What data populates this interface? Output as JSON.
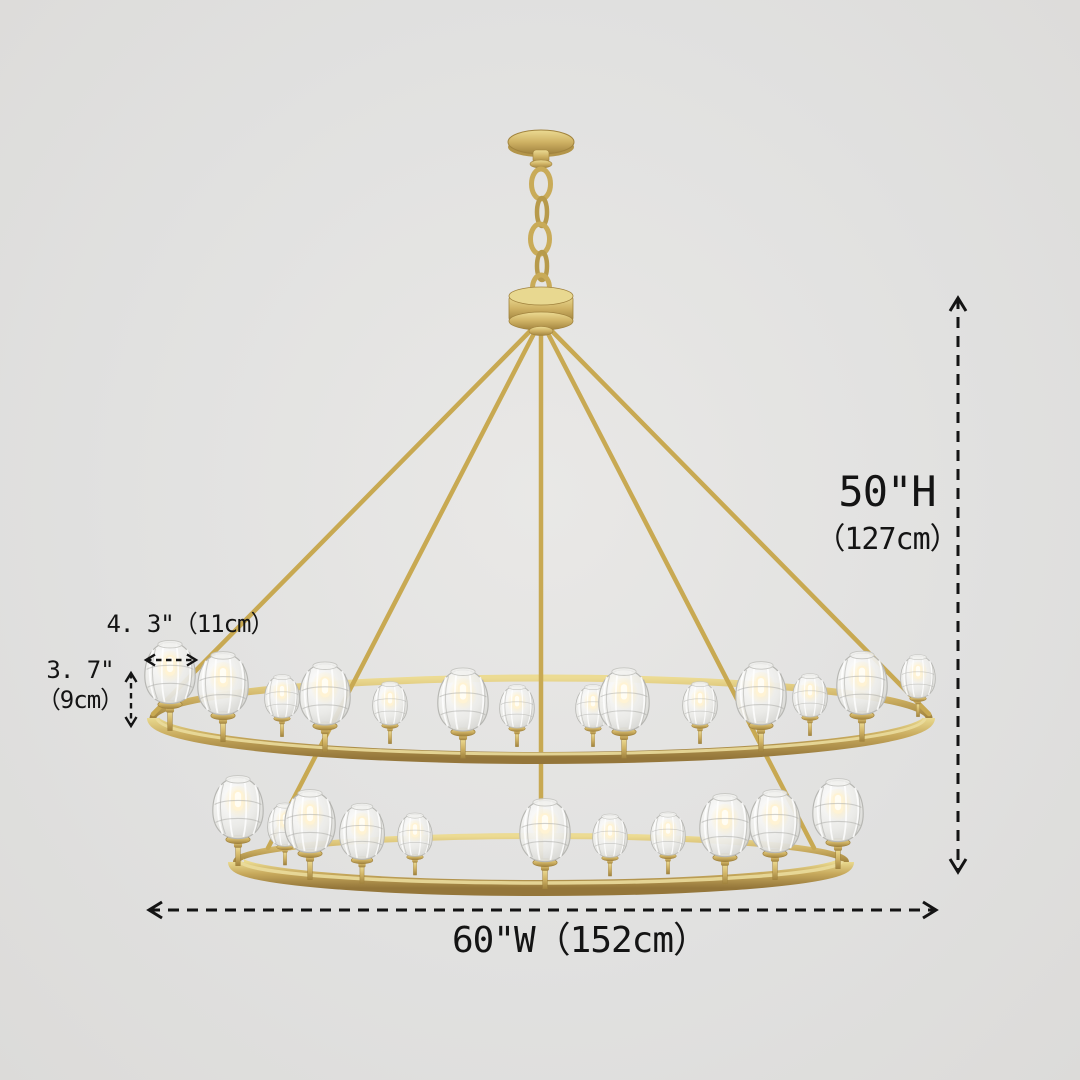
{
  "diagram": {
    "type": "product-dimension-diagram",
    "subject": "two-tier crystal ball chandelier",
    "background_color": "#e1e1e0",
    "brass_color": "#c9a953",
    "dimension_line_color": "#141414"
  },
  "dimensions": {
    "height": {
      "line1": "50\"H",
      "line2": "（127cm）"
    },
    "width": {
      "label": "60\"W（152cm）"
    },
    "shade_width": {
      "label": "4. 3\"（11cm）"
    },
    "shade_height": {
      "line1": "3. 7\"",
      "line2": "（9cm）"
    }
  }
}
